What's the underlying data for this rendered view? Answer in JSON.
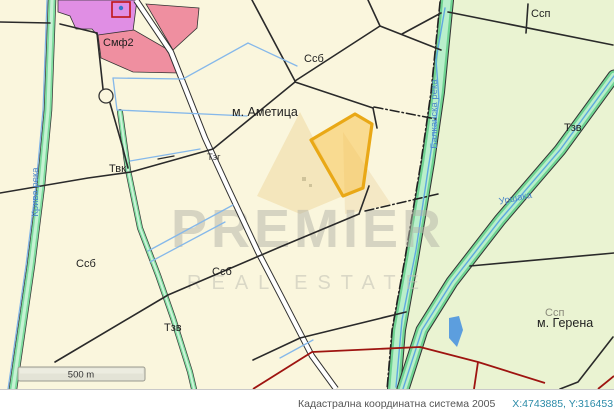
{
  "map": {
    "labels": {
      "smf2": "Смф2",
      "ssb_top": "Ссб",
      "ametitsa": "м. Аметица",
      "ssp_top": "Ссп",
      "tzv_right": "Тзв",
      "tvk": "Твк",
      "tzg": "Тзг",
      "ssb_left": "Ссб",
      "ssb_mid": "Ссб",
      "tzv_bottom": "Тзв",
      "ssp_faint": "Ссп",
      "gerena": "м. Герена"
    },
    "rivers": {
      "kriva": "Крива река",
      "balkanska": "Балканска река",
      "urshaka": "Уршака"
    },
    "watermark": {
      "line1": "PREMIER",
      "line2": "REAL ESTATE"
    },
    "scale_bar": "500 m",
    "highlighted_parcel": {
      "fill": "#f7bf46",
      "border": "#e9a816"
    },
    "colors": {
      "background": "#faf6dd",
      "forest": "#eaf3d2",
      "road_green": "#7edc9e",
      "water": "#5fa8e0",
      "boundary": "#2a2a2a",
      "settlement_pink": "#ef8fa0",
      "settlement_magenta": "#e08ee4",
      "red_boundary": "#9e1410"
    }
  },
  "status_bar": {
    "system": "Кадастрална координатна система 2005",
    "coordinates": "X:4743885, Y:316453",
    "scale_prefix": "Мащ"
  }
}
